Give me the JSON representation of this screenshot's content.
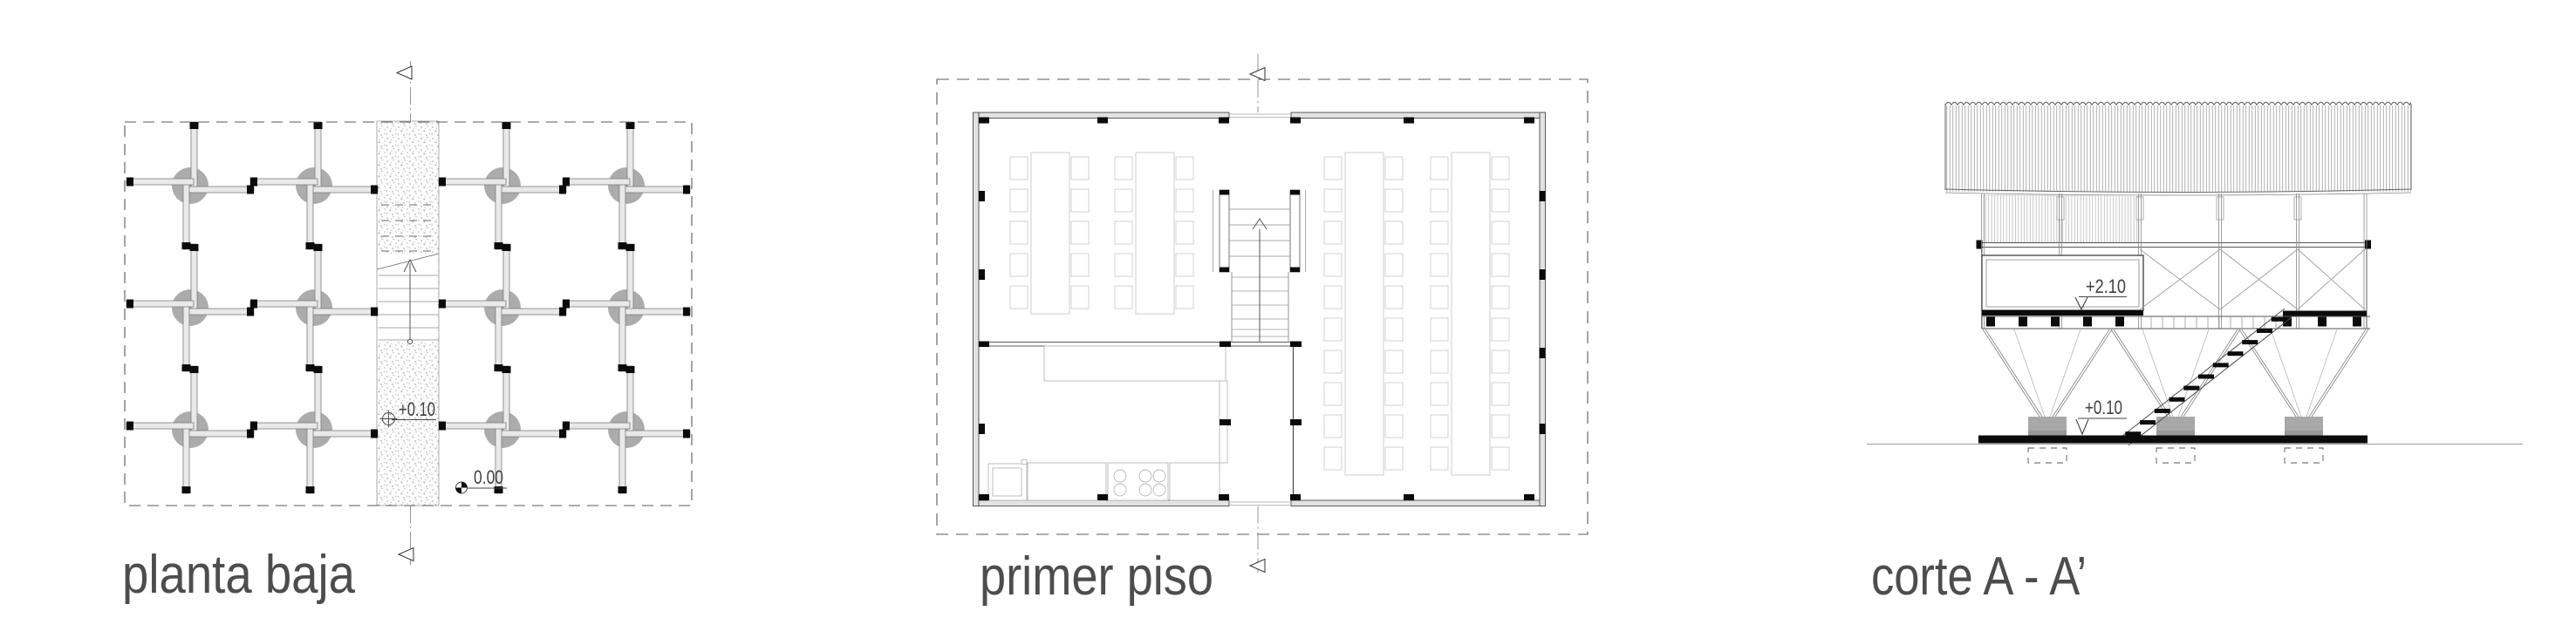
{
  "figures": {
    "planta_baja": {
      "label": "planta baja",
      "levels": {
        "platform": "+0.10",
        "ground": "0.00"
      }
    },
    "primer_piso": {
      "label": "primer piso"
    },
    "corte": {
      "label": "corte A - A’",
      "levels": {
        "floor": "+2.10",
        "ground": "+0.10"
      }
    }
  },
  "colors": {
    "label_text": "#4d4d4d",
    "annotation_text": "#3f3f3f",
    "beam_fill": "#e9e9e9",
    "column_circle": "#acacac",
    "black_elements": "#0b0b0b",
    "footing_gray": "#a8a8a8"
  }
}
